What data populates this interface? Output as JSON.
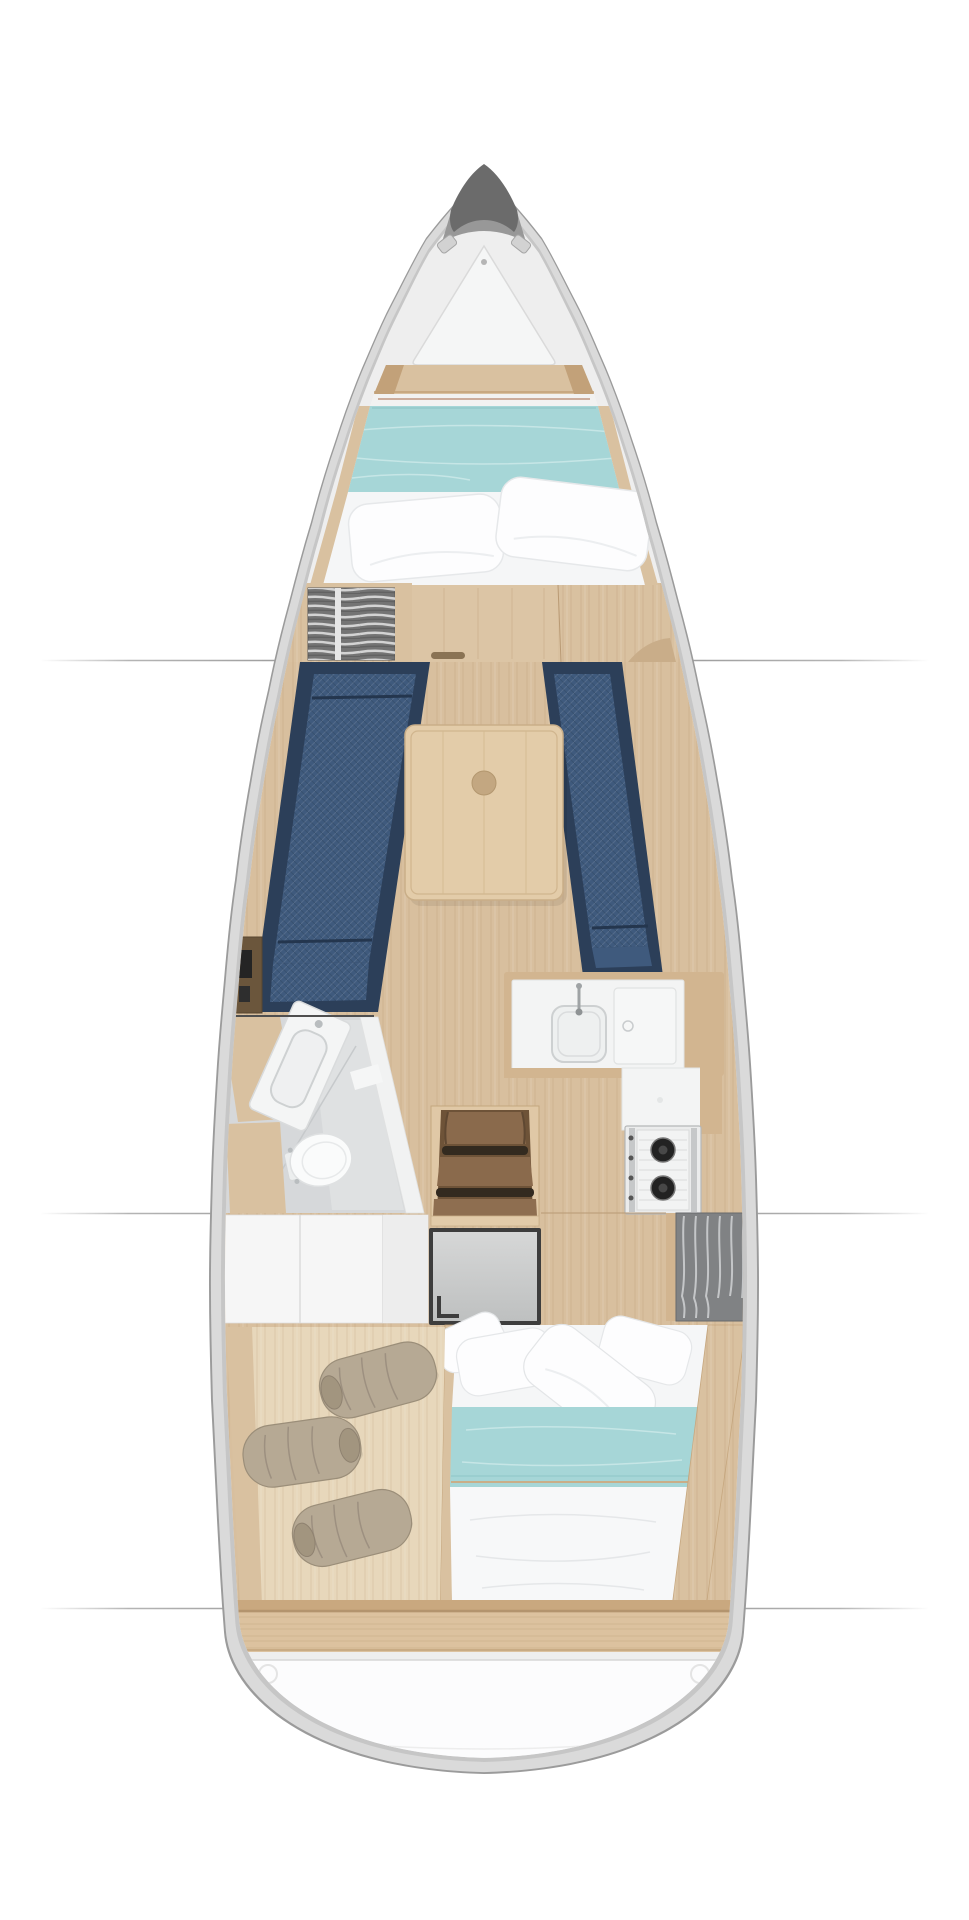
{
  "diagram": {
    "type": "sailboat-interior-floor-plan",
    "view": "top-down deck plan",
    "orientation": "bow-up",
    "compartments": [
      {
        "id": "foredeck",
        "label_semantic": "foredeck with anchor locker hatch"
      },
      {
        "id": "v-berth",
        "label_semantic": "forward cabin double berth with teal blanket and two pillows"
      },
      {
        "id": "forward-bulkhead",
        "label_semantic": "bulkhead with sliding door and hanging locker"
      },
      {
        "id": "salon",
        "label_semantic": "salon with port and starboard navy settees and centerline table"
      },
      {
        "id": "head",
        "label_semantic": "port head with sink, toilet and shower floor"
      },
      {
        "id": "galley",
        "label_semantic": "starboard galley with sink, worktop hatch, two-burner stove and wardrobe"
      },
      {
        "id": "companionway",
        "label_semantic": "companionway steps over engine box"
      },
      {
        "id": "aft-cabin",
        "label_semantic": "aft double berth with teal blanket, duvet and pillows"
      },
      {
        "id": "sail-locker",
        "label_semantic": "port aft stowage with three rolled sail bags"
      },
      {
        "id": "transom",
        "label_semantic": "transom beam and swim platform"
      }
    ],
    "section_lines_y": [
      660,
      1213,
      1608
    ],
    "hull": {
      "bow_tip_y": 166,
      "stern_y": 1774,
      "centerline_x": 484,
      "max_half_beam": 275
    }
  },
  "colors": {
    "page_bg": "#ffffff",
    "hull_rim": "#9b9b9b",
    "hull_band": "#dadada",
    "hull_line": "#c6c6c6",
    "deck": "#eeeeee",
    "bow_cap": "#6b6b6b",
    "bow_cap_light": "#989898",
    "wood_floor": "#d8bf9e",
    "wood_floor_light": "#e7d7bb",
    "wood_trim": "#d9c1a0",
    "wood_dark": "#c2a179",
    "wood_door": "#dcc5a5",
    "wood_beam": "#dcc29f",
    "table_wood": "#e3cca9",
    "table_edge": "#c9ae88",
    "upholstery_frame": "#2c3f59",
    "upholstery": "#3f5a7d",
    "upholstery_seam": "#24364e",
    "blanket_teal": "#a6d6d7",
    "linen_white": "#f5f6f7",
    "pillow_white": "#fdfdfe",
    "locker_gray": "#767676",
    "wardrobe_gray": "#808284",
    "head_floor": "#d6d8da",
    "fixture_white": "#f4f5f5",
    "counter_white": "#f3f4f4",
    "counter_trim": "#d2b590",
    "stove_body": "#ebecec",
    "burner_black": "#222222",
    "steps_wood": "#8a6a4c",
    "steps_well": "#6e5338",
    "steps_gap": "#332a1f",
    "steps_frame": "#e0c8a6",
    "engine_border": "#3d3d3d",
    "engine_gray": "#c9cbcb",
    "bag_beige": "#b6a994",
    "platform_white": "#fcfcfd",
    "section_line": "#777777",
    "red_piping": "#b5846a"
  }
}
